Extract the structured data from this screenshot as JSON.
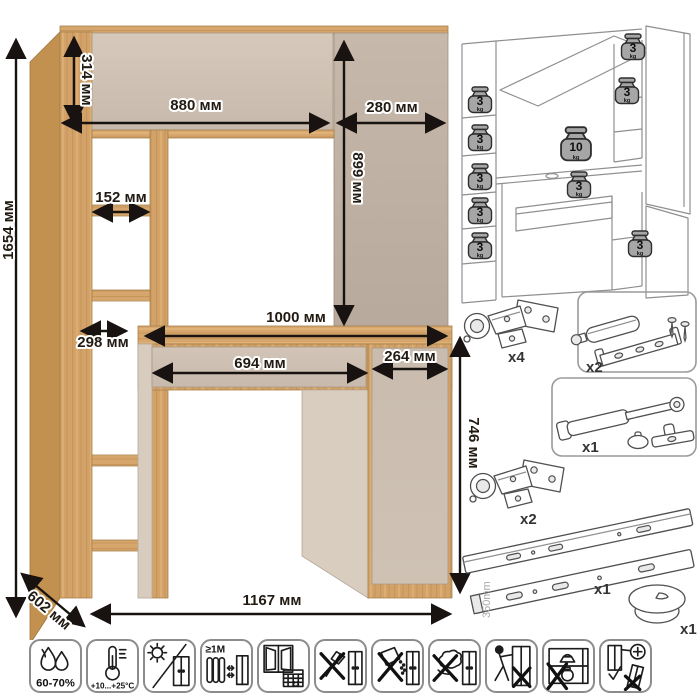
{
  "dimensions": {
    "total_height": "1654 мм",
    "hutch_height": "314 мм",
    "hutch_width": "880 мм",
    "right_door_width": "280 мм",
    "right_door_height": "899 мм",
    "shelf_opening_width": "152 мм",
    "shelf_depth": "298 мм",
    "desktop_width": "1000 мм",
    "drawer_width": "694 мм",
    "pedestal_width": "264 мм",
    "desk_height": "746 мм",
    "depth": "602 мм",
    "total_width": "1167 мм"
  },
  "load_capacity": {
    "shelf": "3",
    "desktop": "10",
    "unit": "kg"
  },
  "hardware": {
    "hinge_flap": {
      "qty": "x4"
    },
    "push_latch": {
      "qty": "x2"
    },
    "gas_lift": {
      "qty": "x1"
    },
    "hinge_door": {
      "qty": "x2"
    },
    "drawer_slides": {
      "qty": "x1",
      "length": "350mm"
    },
    "cable_grommet": {
      "qty": "x1"
    }
  },
  "care": {
    "humidity": "60-70%",
    "temperature": "+10...+25°C",
    "heat_distance": "≥1M",
    "acclimatize_days": "21"
  },
  "colors": {
    "wood": "#d3a269",
    "wood_dark": "#c3914f",
    "panel_beige": "#cdc0b2",
    "panel_taupe": "#c0b2a4",
    "dimension_text": "#221b13",
    "line_art": "#8f8f8f",
    "weight_fill": "#a6a6a6"
  }
}
